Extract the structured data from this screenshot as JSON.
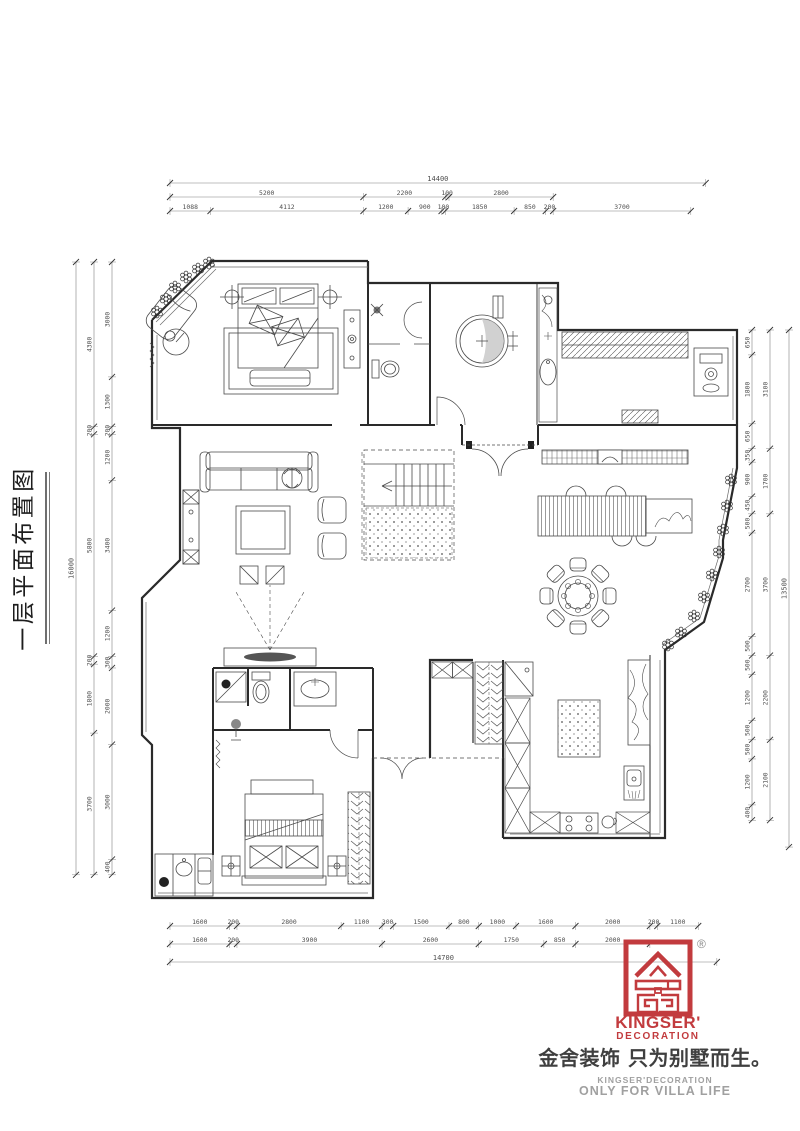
{
  "title": {
    "text": "一层平面布置图"
  },
  "dimensions": {
    "top": {
      "total": [
        "14400"
      ],
      "row2": [
        "5200",
        "2200",
        "100",
        "2800"
      ],
      "row3": [
        "1088",
        "4112",
        "1200",
        "900",
        "100",
        "1850",
        "850",
        "200",
        "3700"
      ]
    },
    "left": {
      "total": [
        "16000"
      ],
      "middle": [
        "4300",
        "200",
        "5800",
        "200",
        "1800",
        "3700"
      ],
      "inner": [
        "3000",
        "1300",
        "200",
        "1200",
        "3400",
        "1200",
        "300",
        "2000",
        "3000",
        "400"
      ]
    },
    "right": {
      "inner": [
        "650",
        "1800",
        "650",
        "350",
        "900",
        "450",
        "500",
        "2700",
        "500",
        "500",
        "1200",
        "500",
        "500",
        "1200",
        "400"
      ],
      "middle": [
        "3100",
        "1700",
        "3700",
        "2200",
        "2100"
      ],
      "total": [
        "13500"
      ]
    },
    "bottom": {
      "row1": [
        "1600",
        "200",
        "2800",
        "1100",
        "300",
        "1500",
        "800",
        "1000",
        "1600",
        "2000",
        "200",
        "1100"
      ],
      "row2": [
        "1600",
        "200",
        "3900",
        "2600",
        "1750",
        "850",
        "2000"
      ],
      "total": [
        "14700"
      ]
    }
  },
  "logo": {
    "registered_mark": "®",
    "brand_line1": "KINGSER'",
    "brand_line2": "DECORATION",
    "tagline_cn": "金舍装饰 只为别墅而生。",
    "sub_brand": "KINGSER'DECORATION",
    "sub_tagline": "ONLY FOR VILLA LIFE",
    "accent_color": "#c23b3e"
  },
  "colors": {
    "wall": "#2a2a2a",
    "furniture": "#4a4a4a",
    "dimension": "#4d4d4d",
    "gray_text": "#a0a0a0"
  }
}
